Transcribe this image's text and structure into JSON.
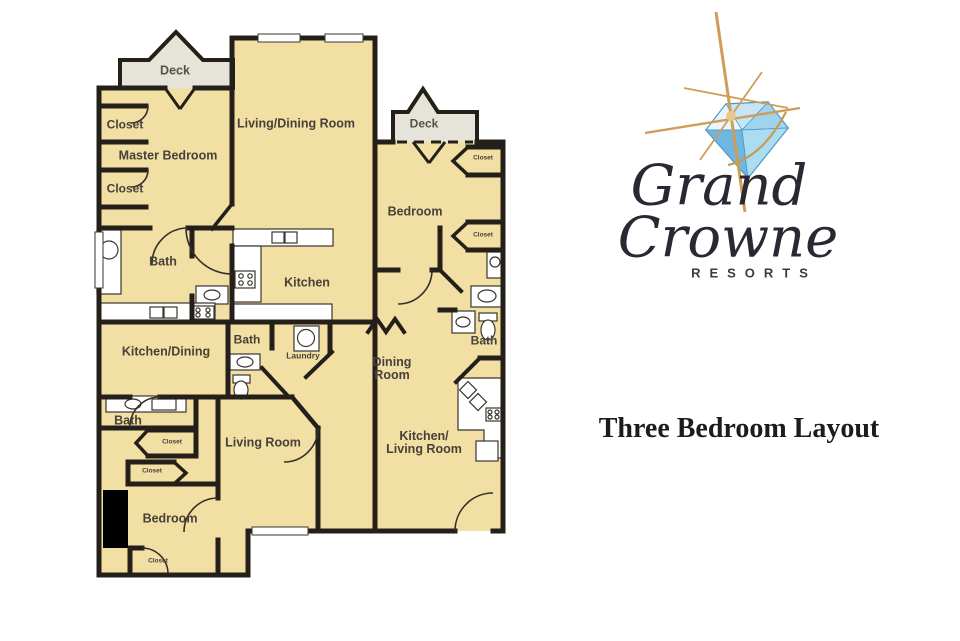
{
  "colors": {
    "floor": "#f2dfa4",
    "deck": "#e6e4da",
    "wall": "#241f19",
    "label_text": "#47413a",
    "gold": "#d3a253",
    "gem_blue": "#8ecbe9",
    "logo_text": "#2a2833"
  },
  "floor_plan": {
    "labels": {
      "deck_left": "Deck",
      "closet_top_1": "Closet",
      "master_bedroom": "Master Bedroom",
      "closet_top_2": "Closet",
      "bath_master": "Bath",
      "kitchen_dining": "Kitchen/Dining",
      "bath_lower": "Bath",
      "closet_small_1": "Closet",
      "closet_small_2": "Closet",
      "bedroom_lower": "Bedroom",
      "closet_small_3": "Closet",
      "living_room": "Living Room",
      "living_dining_room": "Living/Dining Room",
      "kitchen": "Kitchen",
      "bath_center": "Bath",
      "laundry": "Laundry",
      "deck_right": "Deck",
      "bedroom_right": "Bedroom",
      "closet_right_1": "Closet",
      "closet_right_2": "Closet",
      "bath_right": "Bath",
      "dining_room_line1": "Dining",
      "dining_room_line2": "Room",
      "kitchen_living_line1": "Kitchen/",
      "kitchen_living_line2": "Living Room"
    }
  },
  "logo": {
    "word1": "Grand",
    "word2": "Crowne",
    "word3": "RESORTS"
  },
  "caption": {
    "title": "Three Bedroom Layout"
  }
}
